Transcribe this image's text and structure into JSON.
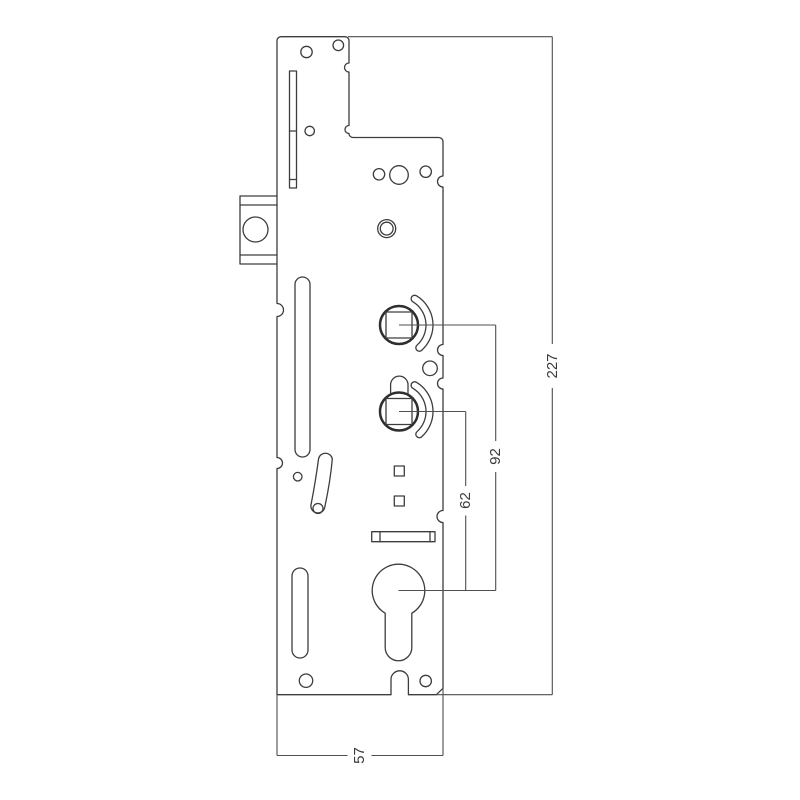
{
  "drawing": {
    "dimensions": {
      "overall_height": "227",
      "upper_spindle_to_cylinder": "92",
      "lower_spindle_to_cylinder": "62",
      "plate_width": "57"
    }
  }
}
